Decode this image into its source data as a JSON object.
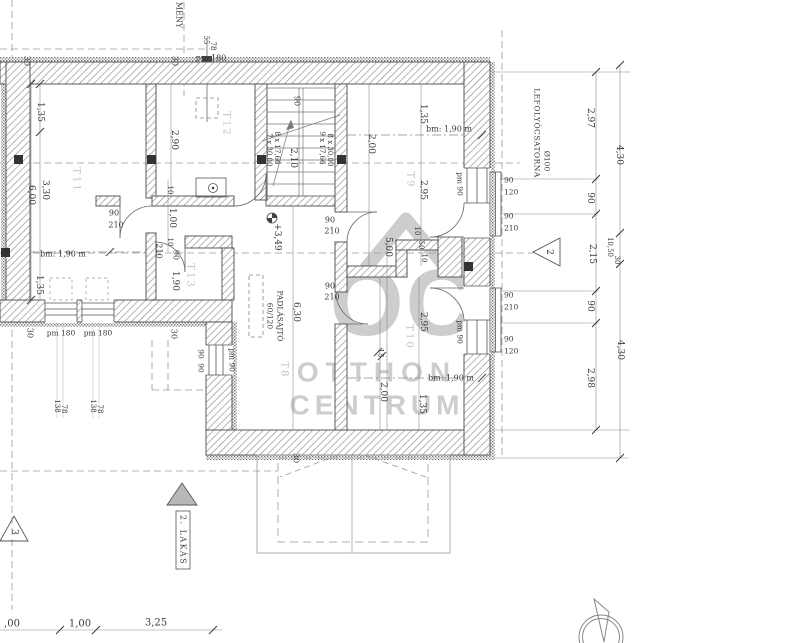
{
  "watermark": {
    "logo": "OC",
    "line1": "OTTHON",
    "line2": "CENTRUM"
  },
  "texts": [
    {
      "n": "dim-135-t11",
      "t": "1,35",
      "x": 40,
      "y": 112,
      "r": 90
    },
    {
      "n": "dim-330-t11",
      "t": "3,30",
      "x": 45,
      "y": 190,
      "r": 90
    },
    {
      "n": "dim-600-t11",
      "t": "6,00",
      "x": 31,
      "y": 195,
      "r": 90
    },
    {
      "n": "dim-30-topleft",
      "t": "30",
      "x": 27,
      "y": 61,
      "r": 90,
      "s": 8
    },
    {
      "n": "dim-30-top",
      "t": "30",
      "x": 175,
      "y": 61,
      "r": 90,
      "s": 8
    },
    {
      "n": "note-pm180-top",
      "t": "pm 180",
      "x": 211,
      "y": 58,
      "s": 8
    },
    {
      "n": "dim-55-chimney",
      "t": "55",
      "x": 206,
      "y": 40,
      "r": 90,
      "s": 7
    },
    {
      "n": "dim-78-chimney",
      "t": "78",
      "x": 213,
      "y": 46,
      "r": 90,
      "s": 7
    },
    {
      "n": "note-kemeny",
      "t": "MÉNY",
      "x": 179,
      "y": 15,
      "r": 90,
      "s": 8
    },
    {
      "n": "dim-290-t12",
      "t": "2,90",
      "x": 174,
      "y": 140,
      "r": 90
    },
    {
      "n": "dim-90-stair",
      "t": "90",
      "x": 297,
      "y": 101,
      "r": 90,
      "s": 8
    },
    {
      "n": "dim-210-stair",
      "t": "2,10",
      "x": 293,
      "y": 158,
      "r": 90
    },
    {
      "n": "stair-steps-left-1",
      "t": "8 x 17,66",
      "x": 277,
      "y": 148,
      "r": 90,
      "s": 7
    },
    {
      "n": "stair-steps-left-2",
      "t": "7 x 30,00",
      "x": 269,
      "y": 150,
      "r": 90,
      "s": 7
    },
    {
      "n": "stair-steps-right-1",
      "t": "9 x 17,66",
      "x": 322,
      "y": 148,
      "r": 90,
      "s": 7
    },
    {
      "n": "stair-steps-right-2",
      "t": "8 x 30,00",
      "x": 330,
      "y": 150,
      "r": 90,
      "s": 7
    },
    {
      "n": "dim-200-t9",
      "t": "2,00",
      "x": 371,
      "y": 144,
      "r": 90
    },
    {
      "n": "dim-135-t9",
      "t": "1,35",
      "x": 423,
      "y": 114,
      "r": 90
    },
    {
      "n": "note-bm-t9",
      "t": "bm: 1,90 m",
      "x": 449,
      "y": 129,
      "s": 8
    },
    {
      "n": "dim-295-t9",
      "t": "2,95",
      "x": 423,
      "y": 190,
      "r": 90
    },
    {
      "n": "note-pm90-t9",
      "t": "pm 90",
      "x": 460,
      "y": 184,
      "r": 90,
      "s": 7.5
    },
    {
      "n": "dim-win-90a",
      "t": "90",
      "x": 504,
      "y": 180,
      "s": 7.5,
      "a": "start"
    },
    {
      "n": "dim-win-120a",
      "t": "120",
      "x": 504,
      "y": 192,
      "s": 7.5,
      "a": "start"
    },
    {
      "n": "dim-door-90a",
      "t": "90",
      "x": 504,
      "y": 216,
      "s": 7.5,
      "a": "start"
    },
    {
      "n": "dim-door-210a",
      "t": "210",
      "x": 504,
      "y": 228,
      "s": 7.5,
      "a": "start"
    },
    {
      "n": "dim-door-90b",
      "t": "90",
      "x": 504,
      "y": 295,
      "s": 7.5,
      "a": "start"
    },
    {
      "n": "dim-door-210b",
      "t": "210",
      "x": 504,
      "y": 307,
      "s": 7.5,
      "a": "start"
    },
    {
      "n": "dim-win-90b",
      "t": "90",
      "x": 504,
      "y": 339,
      "s": 7.5,
      "a": "start"
    },
    {
      "n": "dim-win-120b",
      "t": "120",
      "x": 504,
      "y": 351,
      "s": 7.5,
      "a": "start"
    },
    {
      "n": "dim-door-hall-t9-90",
      "t": "90",
      "x": 330,
      "y": 220,
      "s": 8
    },
    {
      "n": "dim-door-hall-t9-210",
      "t": "210",
      "x": 332,
      "y": 231,
      "s": 8
    },
    {
      "n": "dim-door-hall-t10-90",
      "t": "90",
      "x": 330,
      "y": 286,
      "s": 8
    },
    {
      "n": "dim-door-hall-t10-210",
      "t": "210",
      "x": 332,
      "y": 297,
      "s": 8
    },
    {
      "n": "dim-door-t13-90",
      "t": "90",
      "x": 114,
      "y": 213,
      "s": 8
    },
    {
      "n": "dim-door-t13-210",
      "t": "210",
      "x": 116,
      "y": 225,
      "s": 8
    },
    {
      "n": "dim-10a",
      "t": "10",
      "x": 170,
      "y": 190,
      "r": 90,
      "s": 7
    },
    {
      "n": "dim-100",
      "t": "1,00",
      "x": 172,
      "y": 218,
      "r": 90
    },
    {
      "n": "dim-10b",
      "t": "10",
      "x": 170,
      "y": 242,
      "r": 90,
      "s": 7
    },
    {
      "n": "dim-210-t13",
      "t": "210",
      "x": 159,
      "y": 251,
      "r": 90,
      "s": 8
    },
    {
      "n": "dim-90-t13",
      "t": "90",
      "x": 176,
      "y": 255,
      "r": 90,
      "s": 8
    },
    {
      "n": "dim-190-t13",
      "t": "1,90",
      "x": 175,
      "y": 281,
      "r": 90
    },
    {
      "n": "dim-135-low",
      "t": "1,35",
      "x": 39,
      "y": 285,
      "r": 90
    },
    {
      "n": "note-bm-t11",
      "t": "bm: 1,90 m",
      "x": 63,
      "y": 254,
      "s": 8
    },
    {
      "n": "note-pm180-a",
      "t": "pm 180",
      "x": 61,
      "y": 333,
      "s": 7.5
    },
    {
      "n": "note-pm180-b",
      "t": "pm 180",
      "x": 98,
      "y": 333,
      "s": 7.5
    },
    {
      "n": "dim-138a",
      "t": "138",
      "x": 57,
      "y": 406,
      "r": 90,
      "s": 7
    },
    {
      "n": "dim-78a",
      "t": "78",
      "x": 64,
      "y": 409,
      "r": 90,
      "s": 7
    },
    {
      "n": "dim-138b",
      "t": "138",
      "x": 93,
      "y": 406,
      "r": 90,
      "s": 7
    },
    {
      "n": "dim-78b",
      "t": "78",
      "x": 100,
      "y": 409,
      "r": 90,
      "s": 7
    },
    {
      "n": "dim-30-bl",
      "t": "30",
      "x": 30,
      "y": 333,
      "r": 90,
      "s": 8
    },
    {
      "n": "dim-30-bl2",
      "t": "30",
      "x": 174,
      "y": 334,
      "r": 90,
      "s": 8
    },
    {
      "n": "dim-90-step1",
      "t": "90",
      "x": 201,
      "y": 354,
      "r": 90,
      "s": 7.5
    },
    {
      "n": "dim-90-step2",
      "t": "90",
      "x": 201,
      "y": 368,
      "r": 90,
      "s": 7.5
    },
    {
      "n": "note-pm90-step",
      "t": "pm 90",
      "x": 232,
      "y": 360,
      "r": 90,
      "s": 7.5
    },
    {
      "n": "level-value",
      "t": "+3,49",
      "x": 277,
      "y": 237,
      "r": 90
    },
    {
      "n": "note-atticdoor-size",
      "t": "60/120",
      "x": 270,
      "y": 316,
      "r": 90,
      "s": 7.5
    },
    {
      "n": "note-atticdoor",
      "t": "PADLÁSAJTÓ",
      "x": 280,
      "y": 316,
      "r": 90,
      "s": 7.5
    },
    {
      "n": "dim-630-hall",
      "t": "6,30",
      "x": 296,
      "y": 312,
      "r": 90
    },
    {
      "n": "dim-500",
      "t": "5,00",
      "x": 388,
      "y": 247,
      "r": 90
    },
    {
      "n": "dim-10c",
      "t": "10",
      "x": 417,
      "y": 231,
      "r": 90,
      "s": 7
    },
    {
      "n": "dim-50",
      "t": "50",
      "x": 421,
      "y": 245,
      "r": 90,
      "s": 7
    },
    {
      "n": "dim-10d",
      "t": "10",
      "x": 424,
      "y": 258,
      "r": 90,
      "s": 7
    },
    {
      "n": "dim-295-t10",
      "t": "2,95",
      "x": 423,
      "y": 322,
      "r": 90
    },
    {
      "n": "dim-15",
      "t": "15",
      "x": 381,
      "y": 353,
      "r": 90,
      "s": 7.5
    },
    {
      "n": "dim-200-t10",
      "t": "2,00",
      "x": 383,
      "y": 392,
      "r": 90
    },
    {
      "n": "dim-135-t10",
      "t": "1,35",
      "x": 422,
      "y": 404,
      "r": 90
    },
    {
      "n": "note-bm-t10",
      "t": "bm: 1,90 m",
      "x": 451,
      "y": 378,
      "s": 8
    },
    {
      "n": "note-pm90-t10",
      "t": "pm 90",
      "x": 460,
      "y": 332,
      "r": 90,
      "s": 7.5
    },
    {
      "n": "dim-30-bottom",
      "t": "30",
      "x": 296,
      "y": 458,
      "r": 90,
      "s": 8
    },
    {
      "n": "note-drainpipe",
      "t": "LEFOLYÓCSATORNA",
      "x": 537,
      "y": 133,
      "r": 90,
      "s": 7.5,
      "ls": 0.5
    },
    {
      "n": "note-drainpipe-size",
      "t": "Ø100",
      "x": 547,
      "y": 161,
      "r": 90,
      "s": 7.5
    },
    {
      "n": "dim-297-chain",
      "t": "2,97",
      "x": 590,
      "y": 118,
      "r": 90
    },
    {
      "n": "dim-90-chain1",
      "t": "90",
      "x": 590,
      "y": 198,
      "r": 90
    },
    {
      "n": "dim-215-chain",
      "t": "2,15",
      "x": 592,
      "y": 254,
      "r": 90
    },
    {
      "n": "dim-90-chain2",
      "t": "90",
      "x": 590,
      "y": 306,
      "r": 90
    },
    {
      "n": "dim-298-chain",
      "t": "2,98",
      "x": 590,
      "y": 378,
      "r": 90
    },
    {
      "n": "dim-430-outer1",
      "t": "4,30",
      "x": 619,
      "y": 155,
      "r": 90
    },
    {
      "n": "dim-1050-outer",
      "t": "10,50",
      "x": 610,
      "y": 247,
      "r": 90,
      "s": 7
    },
    {
      "n": "dim-30-outer",
      "t": "30",
      "x": 617,
      "y": 260,
      "r": 90,
      "s": 7
    },
    {
      "n": "dim-430-outer2",
      "t": "4,30",
      "x": 620,
      "y": 350,
      "r": 90
    },
    {
      "n": "dim-bottom-00",
      "t": ",00",
      "x": 12,
      "y": 624,
      "s": 10
    },
    {
      "n": "dim-bottom-100",
      "t": "1,00",
      "x": 80,
      "y": 624,
      "s": 10
    },
    {
      "n": "dim-bottom-325",
      "t": "3,25",
      "x": 156,
      "y": 623,
      "s": 10
    },
    {
      "n": "room-label-t11",
      "t": "T11",
      "x": 76,
      "y": 180,
      "r": 90,
      "s": 10,
      "c": "#c4c4c4",
      "ls": 2
    },
    {
      "n": "room-label-t12",
      "t": "T12",
      "x": 226,
      "y": 124,
      "r": 90,
      "s": 10,
      "c": "#c4c4c4",
      "ls": 2
    },
    {
      "n": "room-label-t13",
      "t": "T13",
      "x": 190,
      "y": 276,
      "r": 90,
      "s": 10,
      "c": "#c4c4c4",
      "ls": 2
    },
    {
      "n": "room-label-t8",
      "t": "T8",
      "x": 284,
      "y": 370,
      "r": 90,
      "s": 10,
      "c": "#c4c4c4",
      "ls": 2
    },
    {
      "n": "room-label-t9",
      "t": "T9",
      "x": 410,
      "y": 180,
      "r": 90,
      "s": 10,
      "c": "#c4c4c4",
      "ls": 2
    },
    {
      "n": "room-label-t10",
      "t": "T10",
      "x": 409,
      "y": 337,
      "r": 90,
      "s": 10,
      "c": "#c4c4c4",
      "ls": 2
    },
    {
      "n": "section-marker-2-label",
      "t": "2",
      "x": 549,
      "y": 252,
      "r": 90,
      "s": 9
    },
    {
      "n": "section-marker-3-label",
      "t": "3",
      "x": 14,
      "y": 532,
      "r": 90,
      "s": 9
    },
    {
      "n": "apartment-label",
      "t": "2. LAKÁS",
      "x": 183,
      "y": 540,
      "r": 90,
      "s": 8,
      "ls": 1.5
    }
  ]
}
